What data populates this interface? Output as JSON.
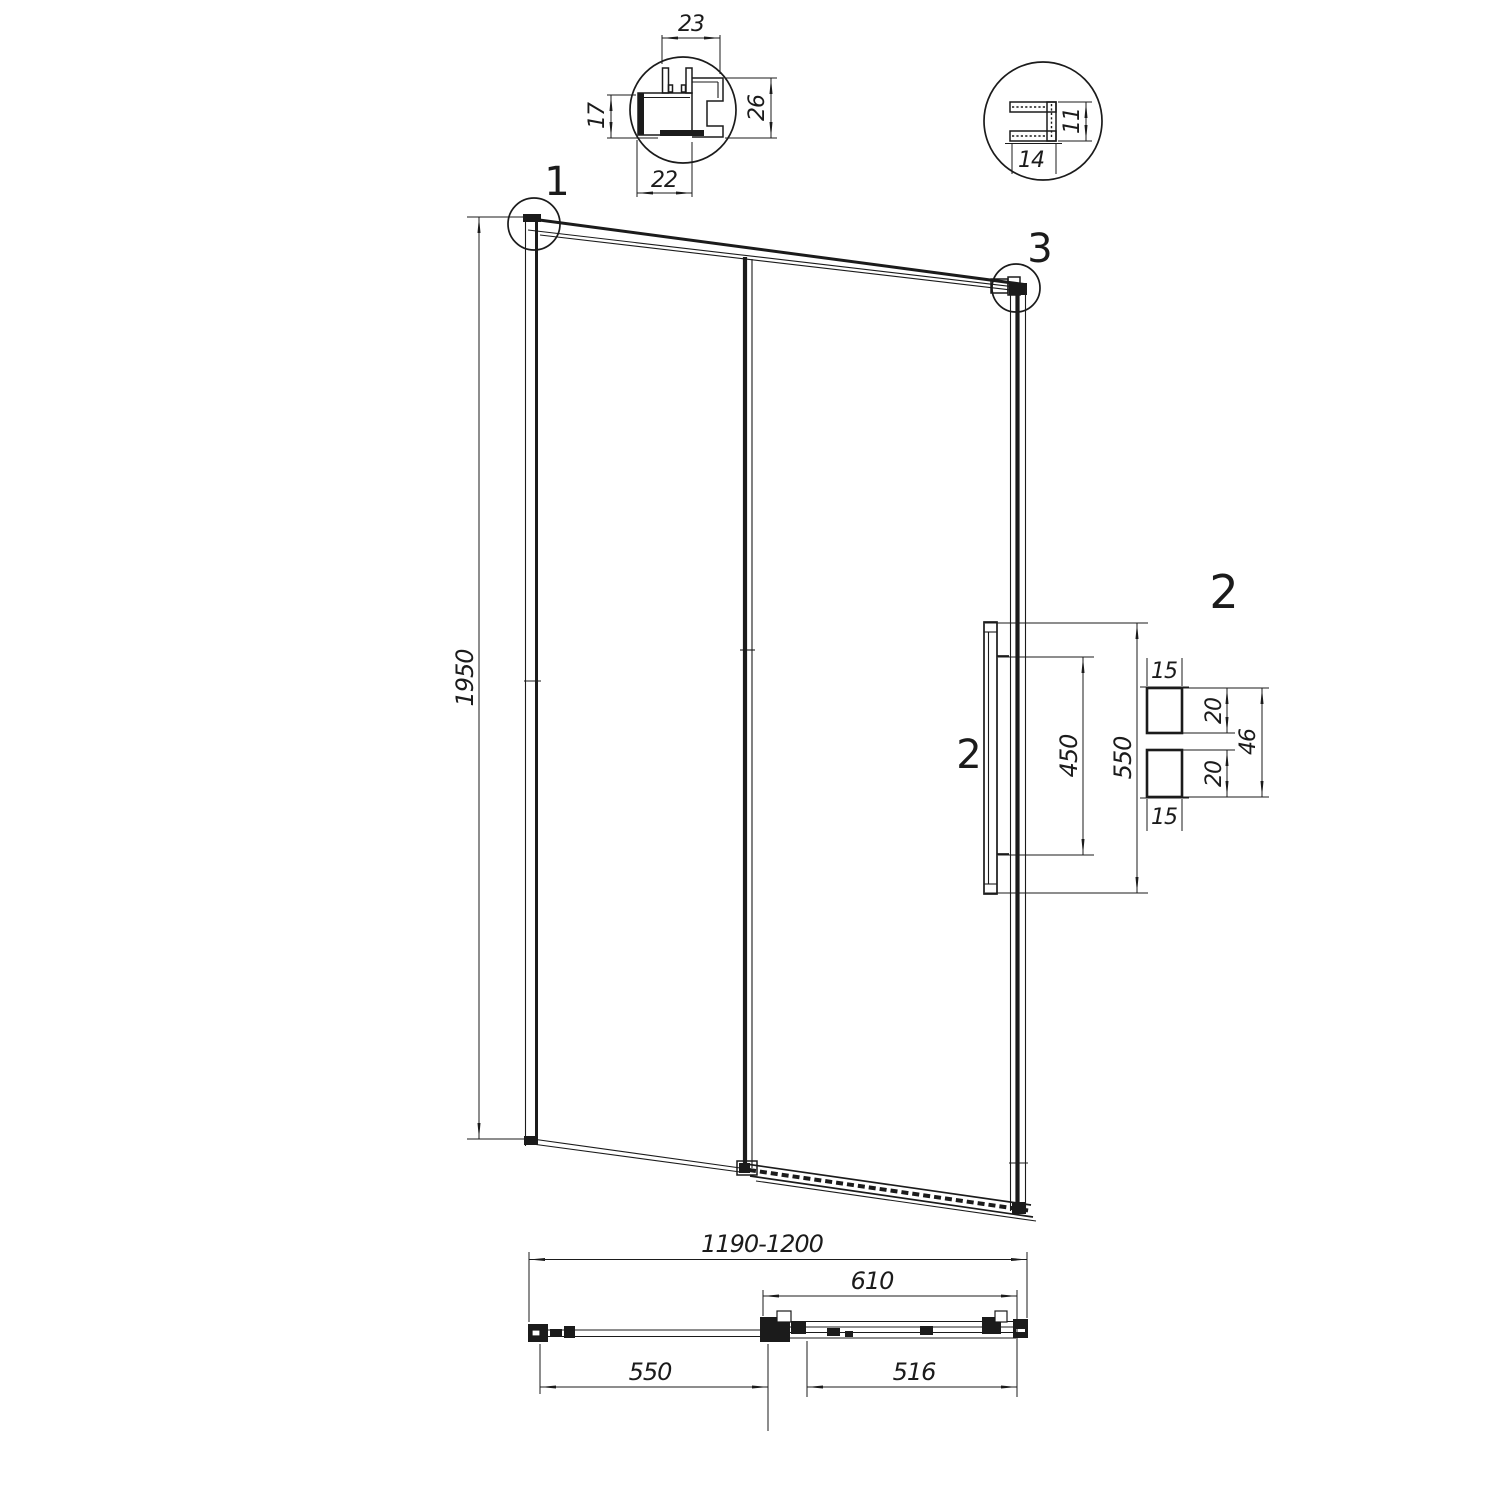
{
  "colors": {
    "line": "#1b1b1b",
    "background": "#ffffff"
  },
  "callouts": {
    "one": "1",
    "three": "3",
    "two_pointer": "2",
    "two_title": "2"
  },
  "wall_profile_detail": {
    "top_width": "23",
    "side_height": "17",
    "right_height": "26",
    "bottom_width": "22"
  },
  "glass_profile_detail": {
    "height": "11",
    "width": "14"
  },
  "elevation": {
    "height": "1950"
  },
  "handle": {
    "length": "550",
    "hole_spacing": "450",
    "top_cap": "15",
    "bottom_cap": "15",
    "upper_knob": "20",
    "lower_knob": "20",
    "depth": "46"
  },
  "plan": {
    "overall": "1190-1200",
    "sliding_panel": "610",
    "fixed_panel": "550",
    "glass_panel": "516"
  }
}
